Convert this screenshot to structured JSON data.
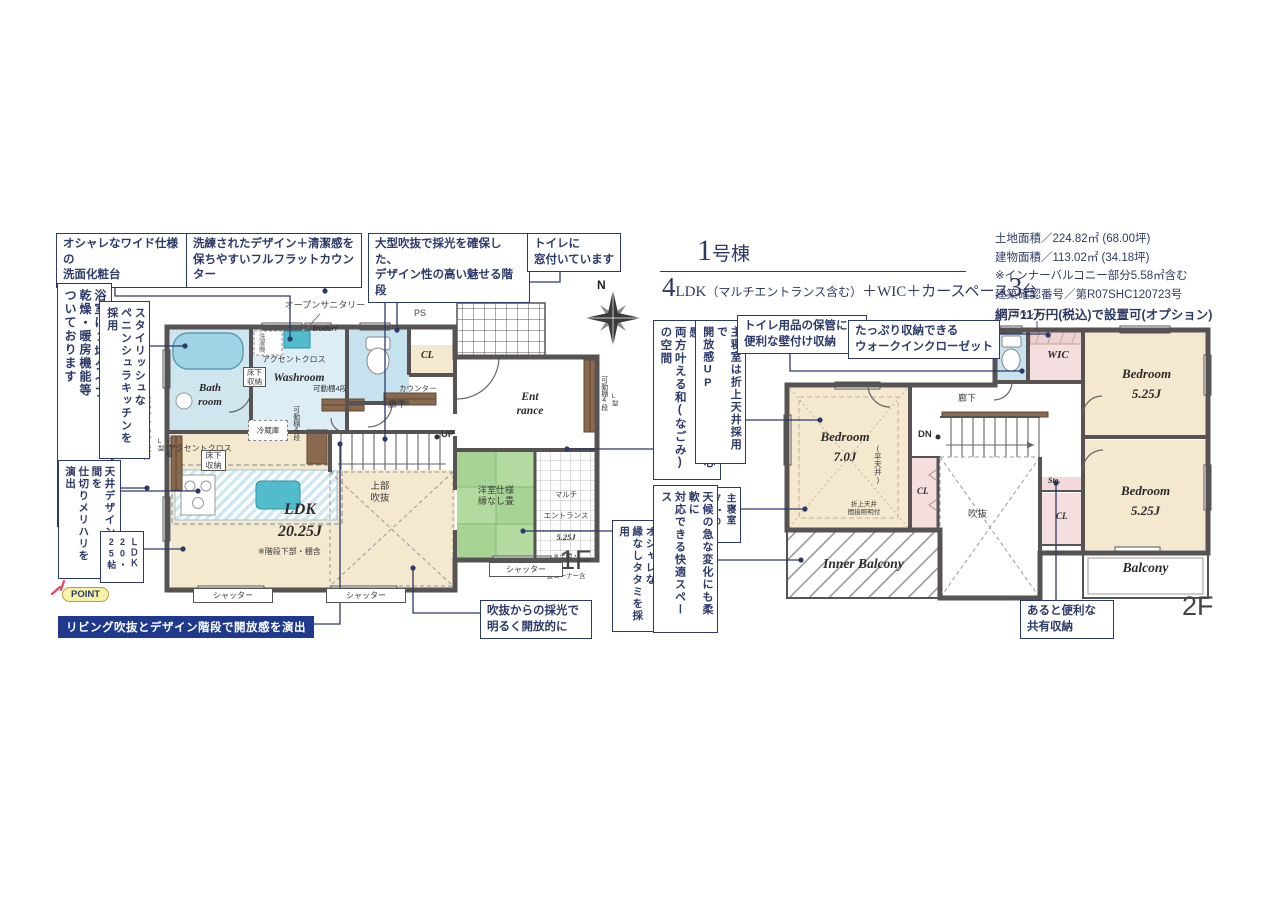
{
  "colors": {
    "navy": "#2c3a6a",
    "bar_navy": "#1f3a8c",
    "point_yellow": "#f8f2a6",
    "tatami_green": "#a7d395",
    "bath_blue": "#cfe6ef",
    "closet_pink": "#f4dede",
    "room_beige": "#f4e8cf",
    "wall_gray": "#575352",
    "sparkle_red": "#e0475a",
    "shelf_brown": "#8a6a4e"
  },
  "header": {
    "building_num": "1",
    "building_suffix": "号棟",
    "ldk_num": "4",
    "ldk_label": "LDK",
    "ldk_paren": "（マルチエントランス含む）",
    "ldk_plus": "＋WIC＋カースペース",
    "car_num": "3",
    "car_unit": "台"
  },
  "info": {
    "line1": "土地面積／224.82㎡ (68.00坪)",
    "line2": "建物面積／113.02㎡ (34.18坪)",
    "line3": "※インナーバルコニー部分5.58㎡含む",
    "line4": "建築確認番号／第R07SHC120723号",
    "line5": "網戸11万円(税込)で設置可(オプション)"
  },
  "callouts": {
    "vanity": "オシャレなワイド仕様の\n洗面化粧台",
    "flat_counter": "洗練されたデザイン＋清潔感を\n保ちやすいフルフラットカウンター",
    "stairs": "大型吹抜で採光を確保した、\nデザイン性の高い魅せる階段",
    "toilet_window": "トイレに\n窓付いています",
    "bath": "浴室は1坪タイプ！\n乾燥・暖房機能等\nついております",
    "kitchen": "スタイリッシュな\nペニンシュラキッチンを採用",
    "ceiling": "天井デザインで空間を\n仕切りメリハリを演出",
    "ldk_size": "ＬＤＫ\n20・25帖",
    "point_badge": "POINT",
    "point_bar": "リビング吹抜とデザイン階段で開放感を演出",
    "void_light": "吹抜からの採光で\n明るく開放的に",
    "doma": "土間の開放感と畳の安心感\n両方叶える和(なごみ)の空間",
    "tatami": "オシャレな\n縁なしタタミを採用",
    "master_ceiling": "主寝室は折上天井採用で\n開放感UP",
    "master_size": "主寝室\n7・0帖",
    "weather": "天候の急な変化にも柔軟に\n対応できる快適スペース",
    "toilet_storage": "トイレ用品の保管に\n便利な壁付け収納",
    "wic": "たっぷり収納できる\nウォークインクローゼット",
    "shared_storage": "あると便利な\n共有収納"
  },
  "f1": {
    "open_sanitary": "オープンサニタリー",
    "open_sanitary_sub": "Irodori",
    "ps": "PS",
    "cl": "CL",
    "bath_room": "Bath\nroom",
    "washer": "洗濯機",
    "accent1": "アクセントクロス",
    "washroom": "Washroom",
    "underfloor1": "床下\n収納",
    "shelf4": "可動棚4段",
    "counter": "カウンター",
    "hallway": "廊下",
    "entrance": "Ent\nrance",
    "shelf4_right": "可動棚4段",
    "shelf4_right2": "L型",
    "up": "UP",
    "fridge": "冷蔵庫",
    "shelf4_mid": "可動棚4段",
    "accent2": "アクセントクロス",
    "underfloor2": "床下\n収納",
    "popup": "ポップアップ天井",
    "shelf_l": "可動棚\nL型",
    "ldk": "LDK\n20.25J",
    "ldk_note": "※階段下部・棚含",
    "upper_void": "上部\n吹抜",
    "tatami": "洋室仕様\n縁なし畳",
    "multi1": "マルチ",
    "multi2": "エントランス",
    "multi3": "5.25J",
    "multi4": "※土間・",
    "multi5": "畳コーナー含",
    "shutter": "シャッター",
    "floor": "1F",
    "north": "N"
  },
  "f2": {
    "counter": "カウンター",
    "wic": "WIC",
    "bedroom_a": "Bedroom\n5.25J",
    "hallway": "廊下",
    "dn": "DN",
    "bedroom_b": "Bedroom\n7.0J",
    "flat_ceiling": "(平天井)",
    "ceiling_note": "折上天井\n間接照明付",
    "cl_a": "CL",
    "void": "吹抜",
    "sto": "Sto.",
    "cl_b": "CL",
    "bedroom_c": "Bedroom\n5.25J",
    "inner_balcony": "Inner Balcony",
    "balcony": "Balcony",
    "floor": "2F"
  }
}
